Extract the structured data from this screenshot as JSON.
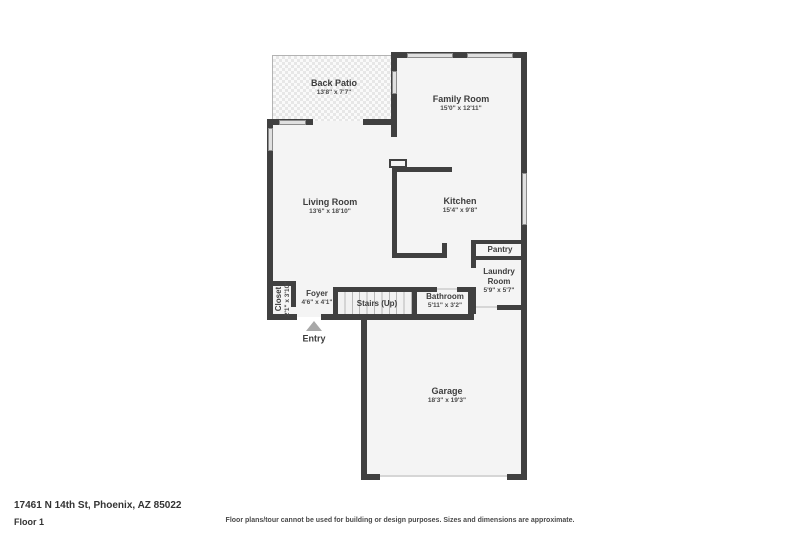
{
  "floor_plan": {
    "rooms": {
      "back_patio": {
        "name": "Back Patio",
        "dims": "13'8\" x 7'7\""
      },
      "family_room": {
        "name": "Family Room",
        "dims": "15'0\" x 12'11\""
      },
      "living_room": {
        "name": "Living Room",
        "dims": "13'6\" x 18'10\""
      },
      "kitchen": {
        "name": "Kitchen",
        "dims": "15'4\" x 9'8\""
      },
      "pantry": {
        "name": "Pantry"
      },
      "laundry_room": {
        "name": "Laundry Room",
        "dims": "5'9\" x 5'7\""
      },
      "closet": {
        "name": "Closet",
        "dims": "2'1\" x 3'10\""
      },
      "foyer": {
        "name": "Foyer",
        "dims": "4'6\" x 4'1\""
      },
      "stairs": {
        "name": "Stairs (Up)"
      },
      "bathroom": {
        "name": "Bathroom",
        "dims": "5'11\" x 3'2\""
      },
      "garage": {
        "name": "Garage",
        "dims": "18'3\" x 19'3\""
      },
      "entry": {
        "name": "Entry"
      }
    },
    "footer": {
      "address": "17461 N 14th St, Phoenix, AZ 85022",
      "floor_label": "Floor 1",
      "disclaimer": "Floor plans/tour cannot be used for building or design purposes. Sizes and dimensions are approximate."
    },
    "colors": {
      "wall": "#404040",
      "room_fill": "#f4f4f4",
      "window_fill": "#e0e0e0",
      "entry_arrow": "#a8a8a8",
      "text": "#3d3d3d"
    }
  }
}
